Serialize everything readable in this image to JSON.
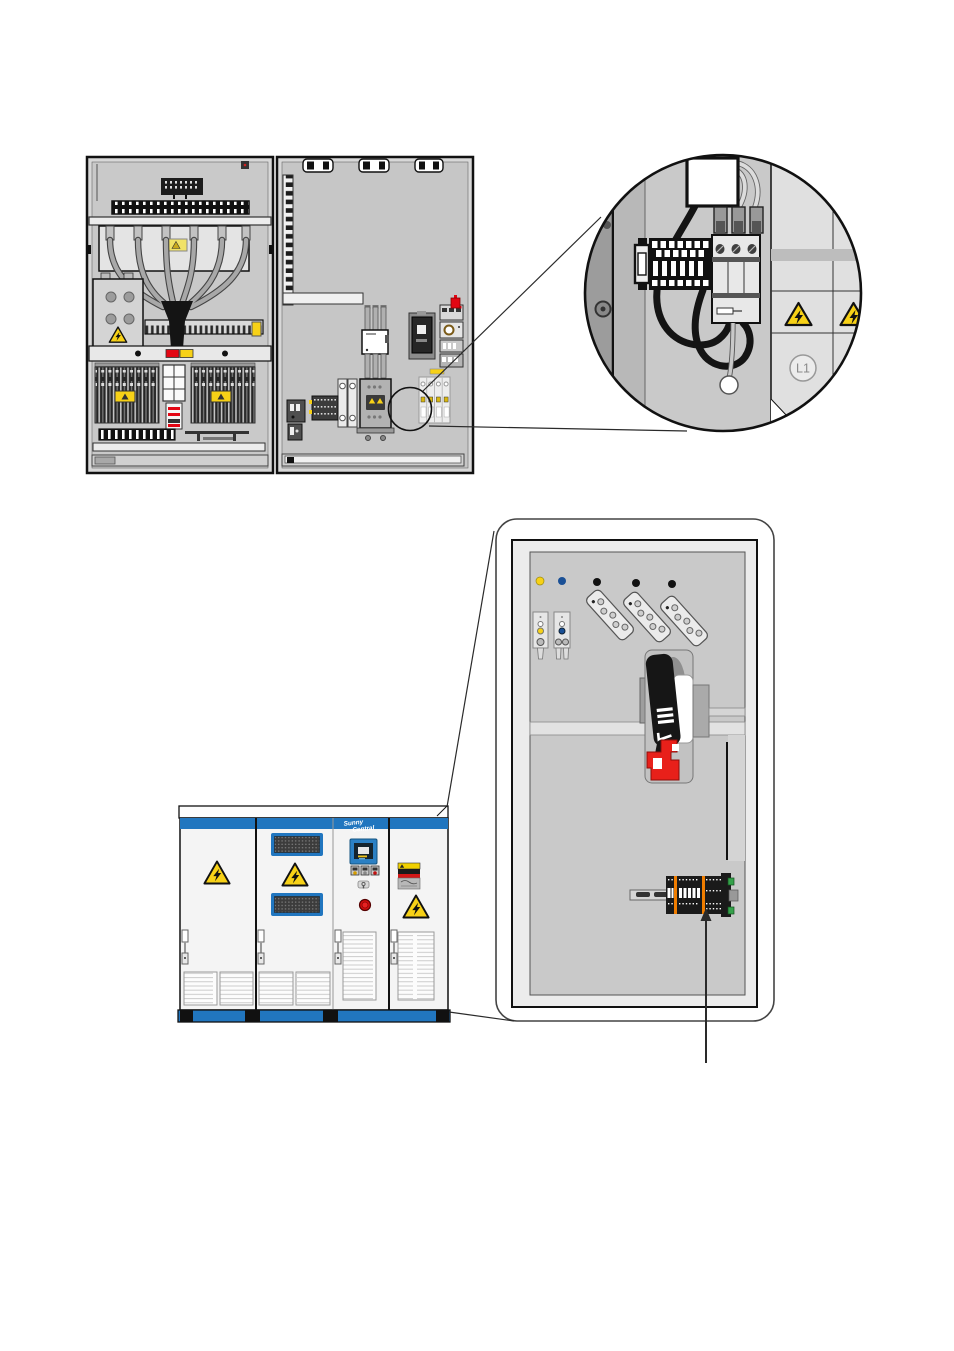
{
  "figure": {
    "detail_circle": {
      "phase_label": "L1"
    },
    "inverter": {
      "brand_line1": "Sunny",
      "brand_line2": "Central"
    },
    "colors": {
      "brand_blue": "#2176bf",
      "warning_yellow": "#f7d117",
      "alert_red": "#e30613",
      "terminal_orange": "#f07d00",
      "din_clip_green": "#35a14b",
      "cabinet_gray": "#c9c9c9",
      "callout_line": "#2a2a2a"
    },
    "icons": [
      "electrical-warning-triangle-icon",
      "emergency-stop-icon",
      "display-screen-icon",
      "door-handle-icon",
      "terminal-block-icon",
      "arrow-up-icon"
    ]
  }
}
